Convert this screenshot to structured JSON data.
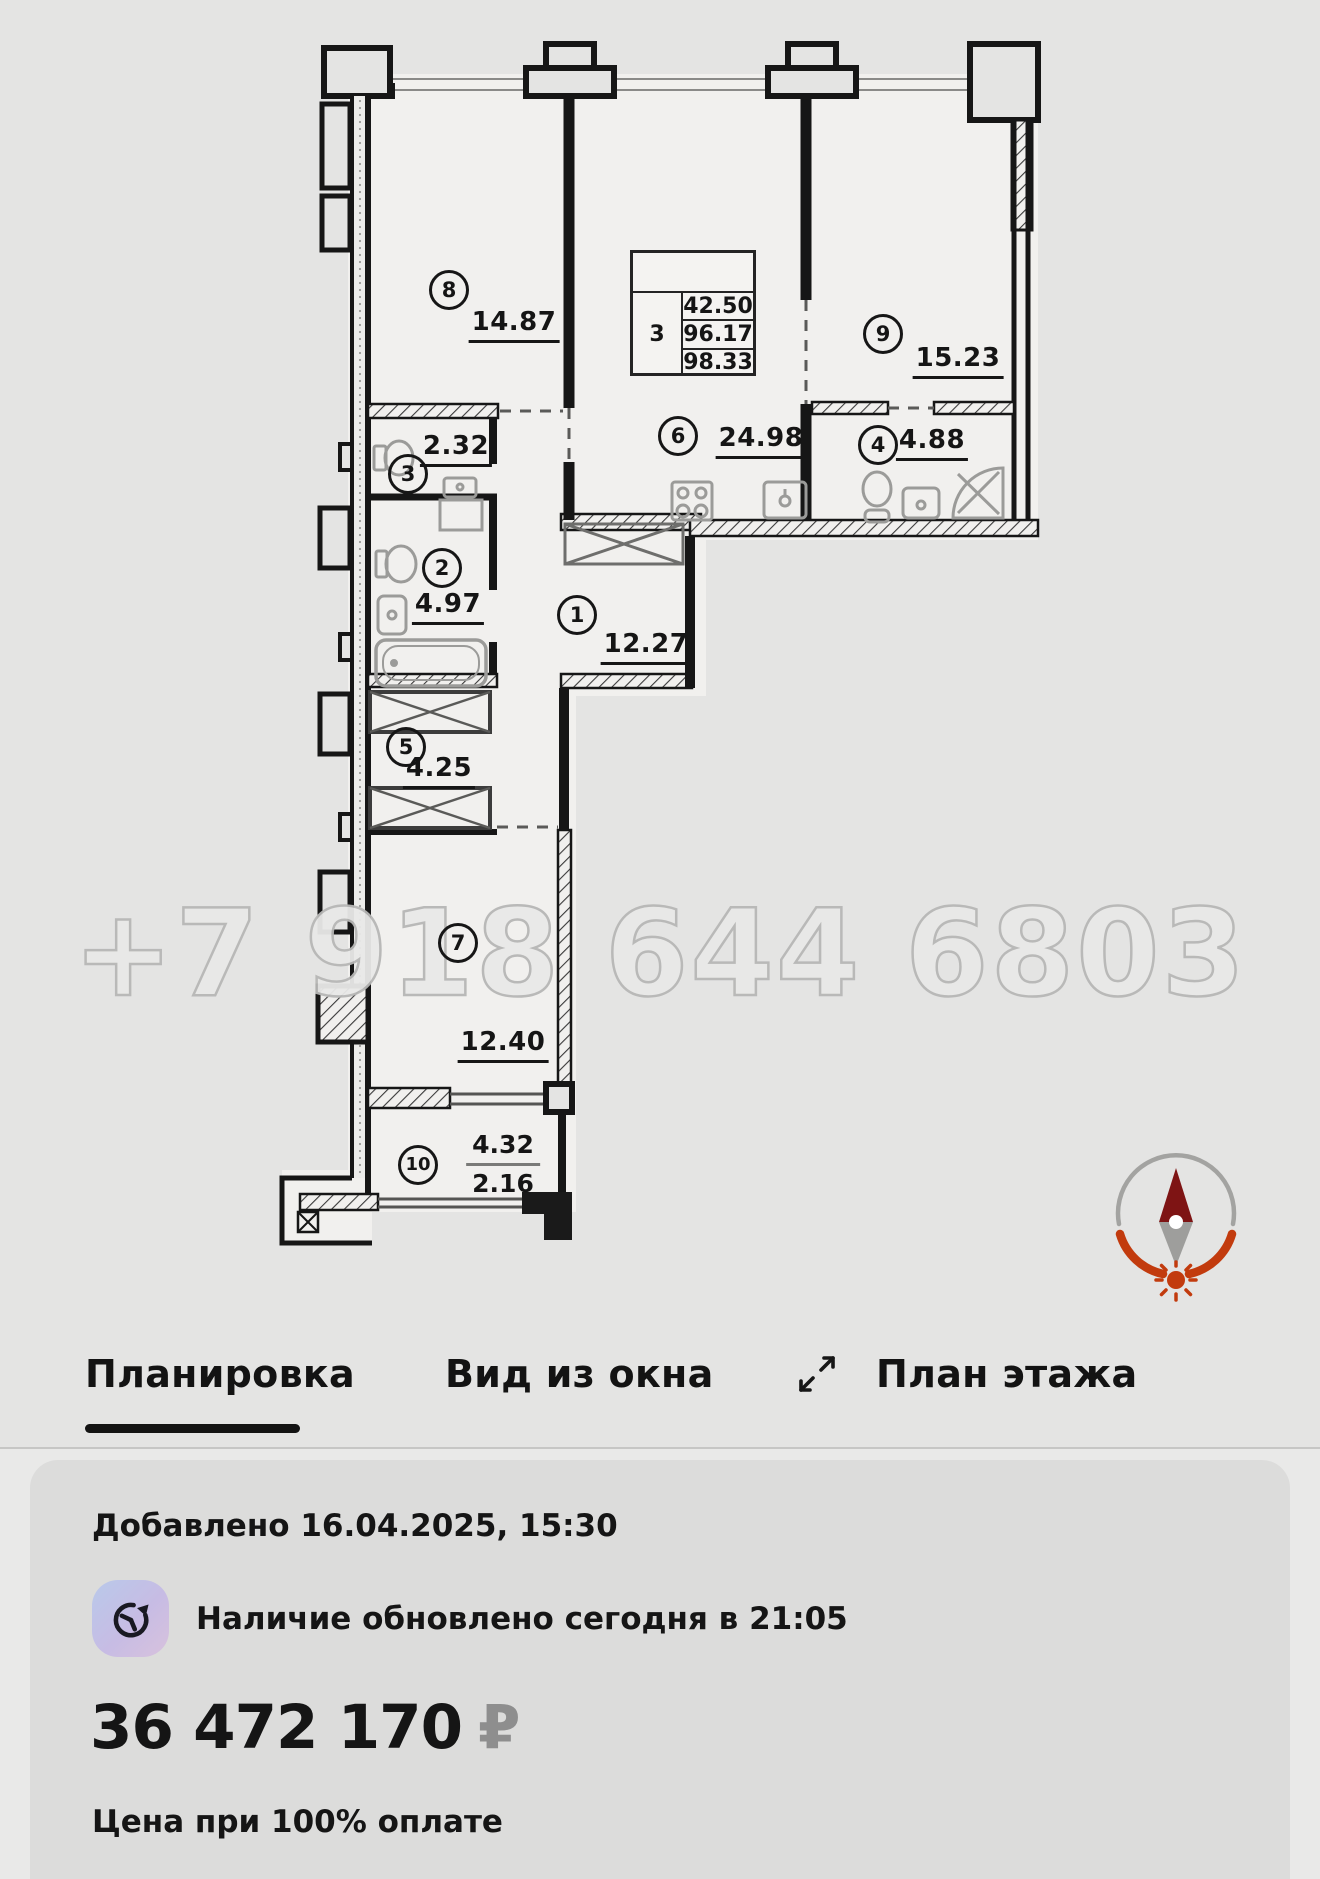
{
  "floor_plan": {
    "watermark": "+7 918 644 6803",
    "info_table": {
      "rooms": "3",
      "row1": "42.50",
      "row2": "96.17",
      "row3": "98.33"
    },
    "rooms": [
      {
        "number": "1",
        "area": "12.27"
      },
      {
        "number": "2",
        "area": "4.97"
      },
      {
        "number": "3",
        "area": "2.32"
      },
      {
        "number": "4",
        "area": "4.88"
      },
      {
        "number": "5",
        "area": "4.25"
      },
      {
        "number": "6",
        "area": "24.98"
      },
      {
        "number": "7",
        "area": "12.40"
      },
      {
        "number": "8",
        "area": "14.87"
      },
      {
        "number": "9",
        "area": "15.23"
      },
      {
        "number": "10",
        "area": "4.32",
        "area_lower": "2.16"
      }
    ]
  },
  "tabs": {
    "layout": "Планировка",
    "window_view": "Вид из окна",
    "floor": "План этажа"
  },
  "details": {
    "added": "Добавлено 16.04.2025, 15:30",
    "availability": "Наличие обновлено сегодня в 21:05",
    "price": "36 472 170",
    "currency": "₽",
    "price_note": "Цена при 100% оплате"
  },
  "colors": {
    "compass_orange": "#c23b0e",
    "compass_maroon": "#7e1414",
    "tab_underline": "#131313",
    "icon_gradient_start": "#b9c9ea",
    "icon_gradient_end": "#d8c2dd"
  }
}
